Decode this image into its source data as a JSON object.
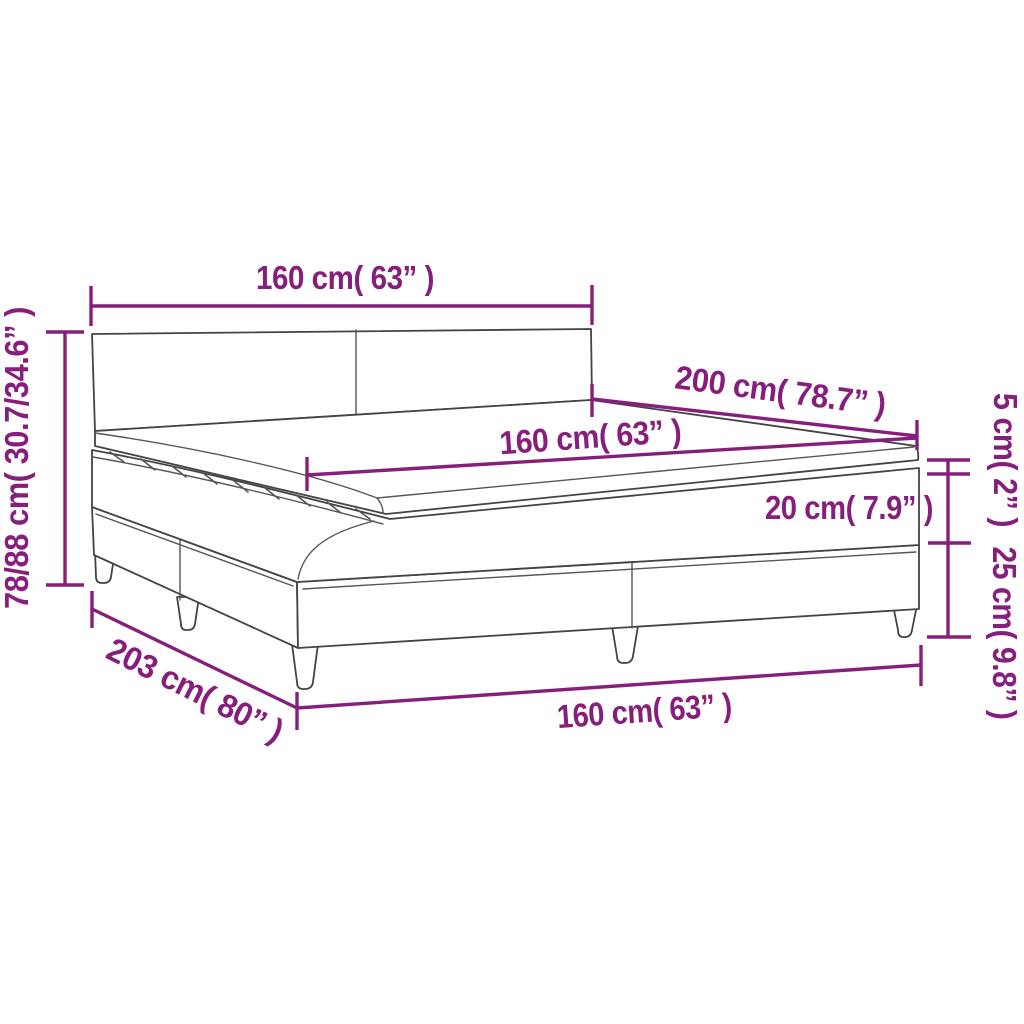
{
  "diagram": {
    "type": "product-dimension-diagram",
    "subject": "box spring bed with mattress and topper",
    "labels": {
      "headboard_width_top": "160 cm( 63” )",
      "overall_height_left": "78/88 cm( 30.7/34.6” )",
      "bed_length_upper": "200 cm( 78.7” )",
      "mattress_width_middle": "160 cm( 63” )",
      "mattress_thickness": "20 cm( 7.9” )",
      "topper_thickness": "5 cm( 2” )",
      "base_height_right": "25 cm( 9.8” )",
      "base_length_bottom_left": "203 cm( 80” )",
      "base_width_bottom": "160 cm( 63” )"
    },
    "colors": {
      "dimension": "#861f7c",
      "drawing_outline": "#444444",
      "background": "#ffffff"
    }
  }
}
